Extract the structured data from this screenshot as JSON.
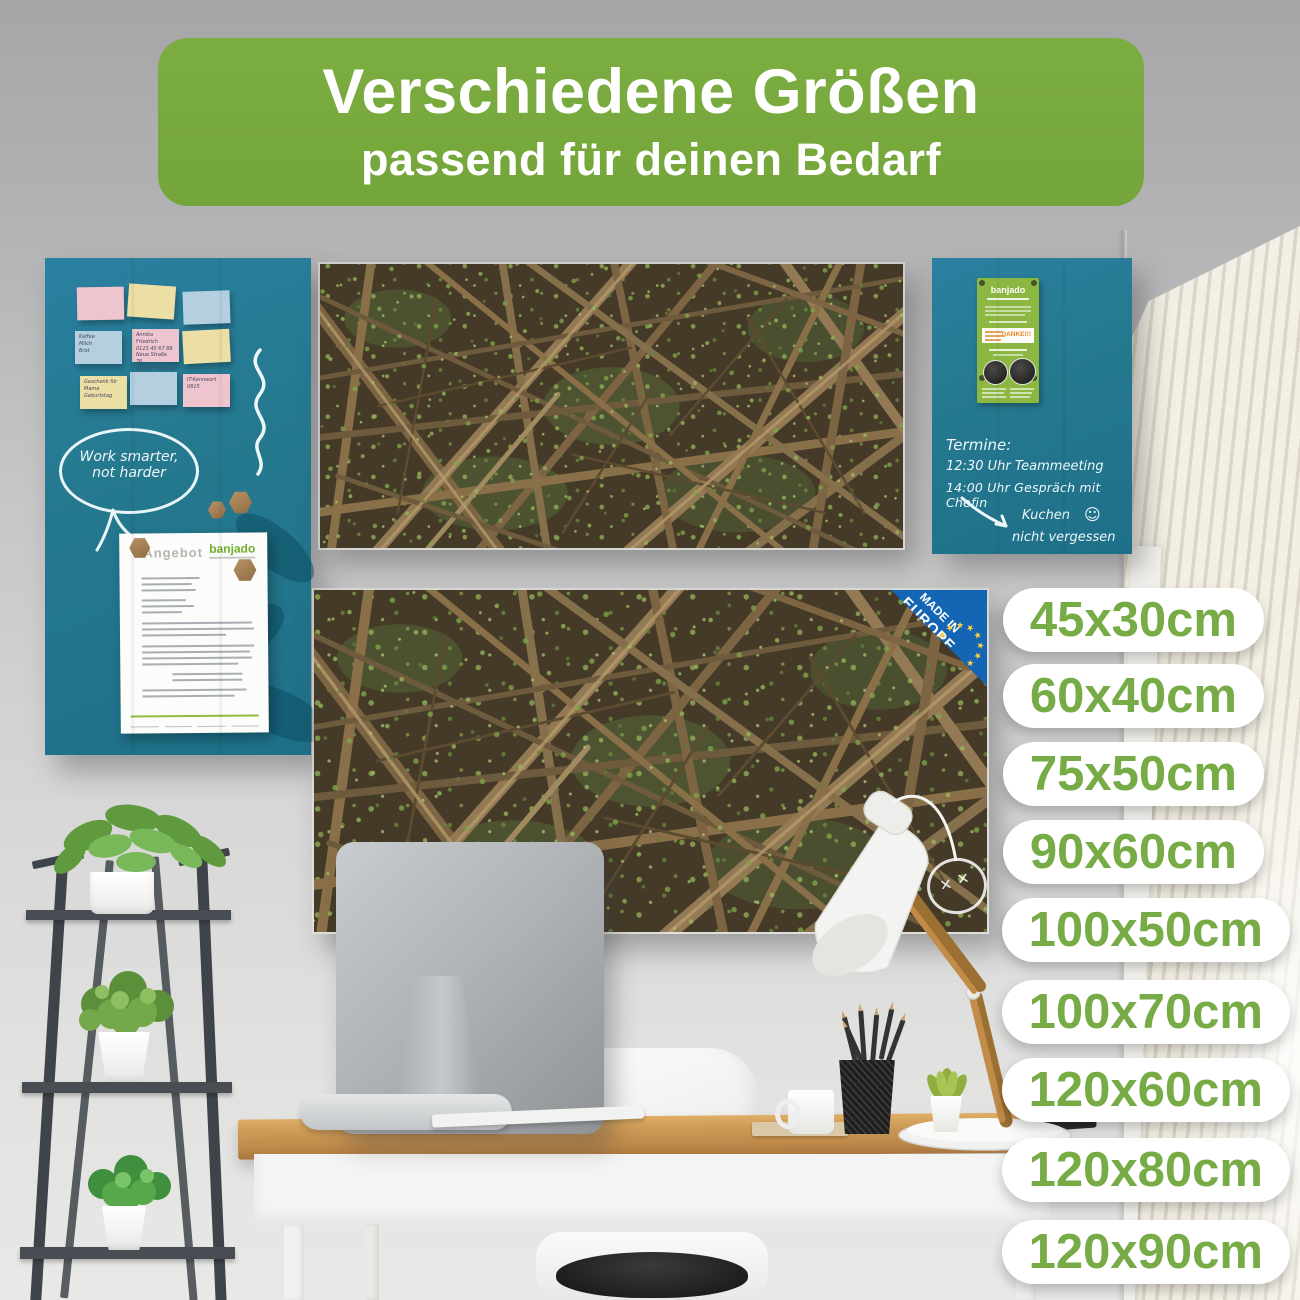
{
  "banner": {
    "title": "Verschiedene Größen",
    "subtitle": "passend für deinen Bedarf"
  },
  "sizes": [
    "45x30cm",
    "60x40cm",
    "75x50cm",
    "90x60cm",
    "100x50cm",
    "100x70cm",
    "120x60cm",
    "120x80cm",
    "120x90cm"
  ],
  "left_board": {
    "bubble_line1": "Work smarter,",
    "bubble_line2": "not harder",
    "notes": {
      "shopping": "Kaffee\nMilch\nBrot",
      "contact": "Annika Friedrich\n0123 45 67 89\nNeue Straße 76\n01234 Freiburg",
      "gift": "Geschenk für\nMama\nGeburtstag",
      "it_note": "IT-Kennwort\n0815"
    },
    "document": {
      "title": "Angebot",
      "brand": "banjado"
    }
  },
  "right_board": {
    "flyer": {
      "brand": "banjado",
      "thanks": "DANKE!!!"
    },
    "lines": [
      "Termine:",
      "12:30 Uhr Teammeeting",
      "14:00 Uhr Gespräch mit Chefin"
    ],
    "reminder": [
      "Kuchen",
      "nicht vergessen"
    ]
  },
  "badge": {
    "line1": "MADE IN",
    "line2": "EUROPE"
  },
  "icons": {
    "smiley": "☺",
    "cross": "✕",
    "star": "★"
  },
  "colors": {
    "banner_green": "#77a83d",
    "pill_green": "#76ab46",
    "board_teal": "#25798f",
    "badge_blue": "#1465b4",
    "flyer_green": "#8cb842",
    "danke_orange": "#e8821e",
    "brand_green": "#6fae2e"
  }
}
